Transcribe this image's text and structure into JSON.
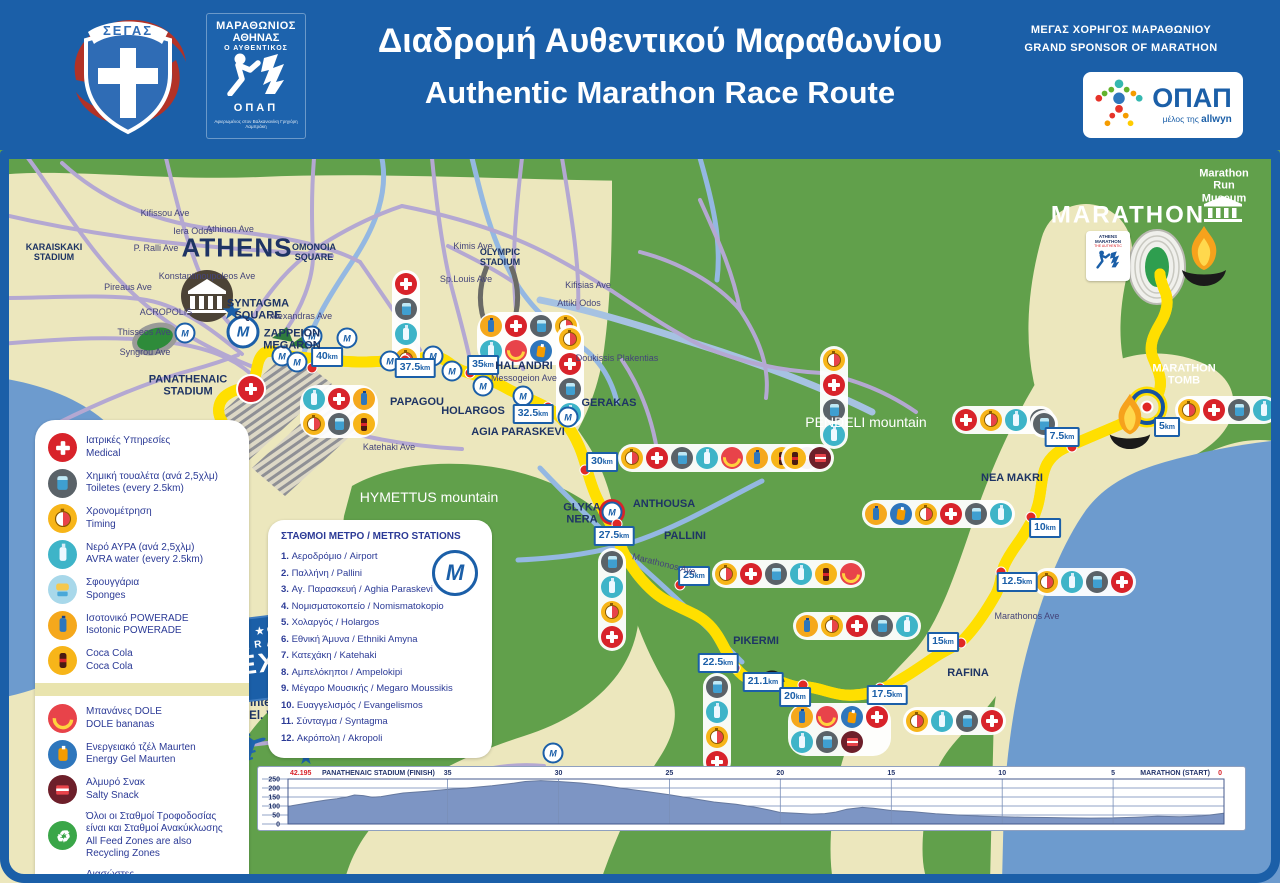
{
  "header": {
    "segas_label": "ΣΕΓΑΣ",
    "marathon_logo": {
      "line1": "ΜΑΡΑΘΩΝΙΟΣ",
      "line2": "ΑΘΗΝΑΣ",
      "line3": "Ο ΑΥΘΕΝΤΙΚΟΣ",
      "opap": "ΟΠΑΠ",
      "caption": "Αφιερωμένος στον Βαλκανιονίκη Γρηγόρη Λαμπράκη"
    },
    "title_el": "Διαδρομή Αυθεντικού Μαραθωνίου",
    "title_en": "Authentic Marathon Race Route",
    "sponsor_line_el": "ΜΕΓΑΣ ΧΟΡΗΓΟΣ ΜΑΡΑΘΩΝΙΟΥ",
    "sponsor_line_en": "GRAND SPONSOR OF MARATHON",
    "opap": {
      "name": "ΟΠΑΠ",
      "member": "μέλος της",
      "brand": "allwyn"
    }
  },
  "legend": {
    "items": [
      {
        "icon": "medical",
        "el": "Ιατρικές Υπηρεσίες",
        "en": "Medical"
      },
      {
        "icon": "toilet",
        "el": "Χημική τουαλέτα (ανά 2,5χλμ)",
        "en": "Toiletes (every 2.5km)"
      },
      {
        "icon": "timing",
        "el": "Χρονομέτρηση",
        "en": "Timing"
      },
      {
        "icon": "water",
        "el": "Νερό ΑΥΡΑ (ανά 2,5χλμ)",
        "en": "AVRA water (every 2.5km)"
      },
      {
        "icon": "sponge",
        "el": "Σφουγγάρια",
        "en": "Sponges"
      },
      {
        "icon": "powerade",
        "el": "Ισοτονικό POWERADE",
        "en": "Isotonic POWERADE"
      },
      {
        "icon": "coke",
        "el": "Coca Cola",
        "en": "Coca Cola"
      },
      {
        "icon": "banana",
        "el": "Μπανάνες DOLE",
        "en": "DOLE bananas",
        "group": 2
      },
      {
        "icon": "gel",
        "el": "Ενεργειακό τζέλ Maurten",
        "en": "Energy Gel Maurten",
        "group": 2
      },
      {
        "icon": "salty",
        "el": "Αλμυρό Σνακ",
        "en": "Salty Snack",
        "group": 2
      },
      {
        "icon": "recycle",
        "el": "Όλοι οι Σταθμοί Τροφοδοσίας είναι και Σταθμοί Ανακύκλωσης",
        "en": "All Feed Zones are also Recycling Zones",
        "group": 2
      },
      {
        "icon": "rescue",
        "el": "Διασώστες",
        "en": "Rescue Team",
        "group": 2
      }
    ]
  },
  "metro": {
    "title": "ΣΤΑΘΜΟΙ ΜΕΤΡΟ / METRO STATIONS",
    "stations": [
      {
        "n": "1.",
        "el": "Αεροδρόμιο",
        "en": "Airport"
      },
      {
        "n": "2.",
        "el": "Παλλήνη",
        "en": "Pallini"
      },
      {
        "n": "3.",
        "el": "Αγ. Παρασκευή",
        "en": "Aghia Paraskevi"
      },
      {
        "n": "4.",
        "el": "Νομισματοκοπείο",
        "en": "Nomismatokopio"
      },
      {
        "n": "5.",
        "el": "Χολαργός",
        "en": "Holargos"
      },
      {
        "n": "6.",
        "el": "Εθνική Άμυνα",
        "en": "Ethniki Amyna"
      },
      {
        "n": "7.",
        "el": "Κατεχάκη",
        "en": "Katehaki"
      },
      {
        "n": "8.",
        "el": "Αμπελόκηποι",
        "en": "Ampelokipi"
      },
      {
        "n": "9.",
        "el": "Μέγαρο Μουσικής",
        "en": "Megaro Moussikis"
      },
      {
        "n": "10.",
        "el": "Ευαγγελισμός",
        "en": "Evangelismos"
      },
      {
        "n": "11.",
        "el": "Σύνταγμα",
        "en": "Syntagma"
      },
      {
        "n": "12.",
        "el": "Ακρόπολη",
        "en": "Akropoli"
      }
    ]
  },
  "map": {
    "km_unit": "km",
    "metro_glyph": "M",
    "glyphs": {
      "plane": "✈",
      "star": "★",
      "recycle": "♻"
    },
    "expo": {
      "brand": "ΟΠΑΠ",
      "line1": "MARATHON",
      "line2": "EXPO"
    },
    "athens_logo": {
      "l1": "ATHENS",
      "l2": "MARATHON",
      "l3": "THE AUTHENTIC"
    },
    "labels": [
      {
        "t": "ATHENS",
        "x": 237,
        "y": 248,
        "c": "city"
      },
      {
        "t": "MARATHON",
        "x": 1128,
        "y": 216,
        "c": "bigwhite"
      },
      {
        "t": "KARAISKAKI\nSTADIUM",
        "x": 54,
        "y": 252,
        "c": "towns"
      },
      {
        "t": "OMONOIA\nSQUARE",
        "x": 314,
        "y": 252,
        "c": "towns"
      },
      {
        "t": "SYNTAGMA\nSQUARE",
        "x": 258,
        "y": 310,
        "c": "town"
      },
      {
        "t": "ZAPPEION\nMEGARON",
        "x": 292,
        "y": 340,
        "c": "town"
      },
      {
        "t": "PANATHENAIC\nSTADIUM",
        "x": 188,
        "y": 386,
        "c": "town"
      },
      {
        "t": "ACROPOLIS",
        "x": 166,
        "y": 312,
        "c": "street"
      },
      {
        "t": "Kifissou Ave",
        "x": 165,
        "y": 213,
        "c": "street"
      },
      {
        "t": "Iera Odos",
        "x": 193,
        "y": 231,
        "c": "street"
      },
      {
        "t": "Athinon Ave",
        "x": 230,
        "y": 229,
        "c": "street"
      },
      {
        "t": "P. Ralli Ave",
        "x": 156,
        "y": 248,
        "c": "street"
      },
      {
        "t": "Konstantinoupoleos Ave",
        "x": 207,
        "y": 276,
        "c": "street"
      },
      {
        "t": "Pireaus Ave",
        "x": 128,
        "y": 287,
        "c": "street"
      },
      {
        "t": "Thisseos Ave",
        "x": 144,
        "y": 332,
        "c": "street"
      },
      {
        "t": "Syngrou Ave",
        "x": 145,
        "y": 352,
        "c": "street"
      },
      {
        "t": "Alexandras Ave",
        "x": 301,
        "y": 316,
        "c": "street"
      },
      {
        "t": "Katehaki Ave",
        "x": 389,
        "y": 447,
        "c": "street"
      },
      {
        "t": "Kimis Ave",
        "x": 473,
        "y": 246,
        "c": "street"
      },
      {
        "t": "OLYMPIC\nSTADIUM",
        "x": 500,
        "y": 257,
        "c": "towns"
      },
      {
        "t": "Sp.Louis Ave",
        "x": 466,
        "y": 279,
        "c": "street"
      },
      {
        "t": "Kifisias Ave",
        "x": 588,
        "y": 285,
        "c": "street"
      },
      {
        "t": "Attiki Odos",
        "x": 579,
        "y": 303,
        "c": "street"
      },
      {
        "t": "Doukissis Plakentias",
        "x": 617,
        "y": 358,
        "c": "street"
      },
      {
        "t": "HALANDRI",
        "x": 524,
        "y": 366,
        "c": "town"
      },
      {
        "t": "Messogeion Ave",
        "x": 524,
        "y": 378,
        "c": "street"
      },
      {
        "t": "PAPAGOU",
        "x": 417,
        "y": 402,
        "c": "town"
      },
      {
        "t": "HOLARGOS",
        "x": 473,
        "y": 411,
        "c": "town"
      },
      {
        "t": "AGIA PARASKEVI",
        "x": 518,
        "y": 432,
        "c": "town"
      },
      {
        "t": "GERAKAS",
        "x": 609,
        "y": 403,
        "c": "town"
      },
      {
        "t": "HYMETTUS mountain",
        "x": 429,
        "y": 498,
        "c": "mtn"
      },
      {
        "t": "PENDELI mountain",
        "x": 866,
        "y": 423,
        "c": "mtn"
      },
      {
        "t": "GLYKA\nNERA",
        "x": 582,
        "y": 514,
        "c": "town"
      },
      {
        "t": "ANTHOUSA",
        "x": 664,
        "y": 504,
        "c": "town"
      },
      {
        "t": "PALLINI",
        "x": 685,
        "y": 536,
        "c": "town"
      },
      {
        "t": "PIKERMI",
        "x": 756,
        "y": 641,
        "c": "town"
      },
      {
        "t": "Marathonos Ave",
        "x": 664,
        "y": 564,
        "c": "street",
        "r": 14
      },
      {
        "t": "Marathonos Ave",
        "x": 1027,
        "y": 616,
        "c": "street"
      },
      {
        "t": "RAFINA",
        "x": 968,
        "y": 673,
        "c": "town"
      },
      {
        "t": "NEA MAKRI",
        "x": 1012,
        "y": 478,
        "c": "town"
      },
      {
        "t": "MARATHON TOMB",
        "x": 1184,
        "y": 375,
        "c": "wsmall"
      },
      {
        "t": "Marathon Run\nMuseum",
        "x": 1224,
        "y": 186,
        "c": "wsmall"
      },
      {
        "t": "Athens International Airport\n“El. Venizelos”",
        "x": 284,
        "y": 710,
        "c": "airport"
      }
    ],
    "km_markers": [
      {
        "t": "40",
        "x": 327,
        "y": 357
      },
      {
        "t": "37.5",
        "x": 415,
        "y": 368
      },
      {
        "t": "35",
        "x": 483,
        "y": 365
      },
      {
        "t": "32.5",
        "x": 533,
        "y": 414
      },
      {
        "t": "30",
        "x": 602,
        "y": 462
      },
      {
        "t": "27.5",
        "x": 614,
        "y": 536
      },
      {
        "t": "25",
        "x": 694,
        "y": 576
      },
      {
        "t": "22.5",
        "x": 718,
        "y": 663
      },
      {
        "t": "21.1",
        "x": 763,
        "y": 682
      },
      {
        "t": "20",
        "x": 795,
        "y": 697
      },
      {
        "t": "17.5",
        "x": 887,
        "y": 695
      },
      {
        "t": "15",
        "x": 943,
        "y": 642
      },
      {
        "t": "12.5",
        "x": 1017,
        "y": 582
      },
      {
        "t": "10",
        "x": 1045,
        "y": 528
      },
      {
        "t": "7.5",
        "x": 1062,
        "y": 437
      },
      {
        "t": "5",
        "x": 1167,
        "y": 427
      }
    ],
    "dots": [
      [
        312,
        368
      ],
      [
        405,
        360
      ],
      [
        470,
        373
      ],
      [
        548,
        407
      ],
      [
        585,
        470
      ],
      [
        617,
        524
      ],
      [
        680,
        585
      ],
      [
        735,
        668
      ],
      [
        803,
        685
      ],
      [
        880,
        688
      ],
      [
        961,
        643
      ],
      [
        1001,
        572
      ],
      [
        1031,
        517
      ],
      [
        1072,
        447
      ]
    ],
    "metro_icons": [
      {
        "x": 185,
        "y": 333
      },
      {
        "x": 243,
        "y": 332,
        "b": 1
      },
      {
        "x": 312,
        "y": 336
      },
      {
        "x": 282,
        "y": 356
      },
      {
        "x": 297,
        "y": 362
      },
      {
        "x": 347,
        "y": 338
      },
      {
        "x": 390,
        "y": 361
      },
      {
        "x": 433,
        "y": 356
      },
      {
        "x": 452,
        "y": 371
      },
      {
        "x": 483,
        "y": 386
      },
      {
        "x": 523,
        "y": 396
      },
      {
        "x": 568,
        "y": 417
      },
      {
        "x": 612,
        "y": 512,
        "r": 1
      },
      {
        "x": 553,
        "y": 753
      }
    ],
    "clusters": [
      {
        "x": 392,
        "y": 270,
        "dir": "v",
        "icons": [
          "medical",
          "toilet",
          "water",
          "timing"
        ]
      },
      {
        "x": 477,
        "y": 312,
        "dir": "g",
        "cols": 4,
        "icons": [
          "powerade",
          "medical",
          "toilet",
          "timing",
          "water",
          "banana",
          "gel"
        ]
      },
      {
        "x": 556,
        "y": 325,
        "dir": "v",
        "icons": [
          "timing",
          "medical",
          "toilet",
          "water"
        ]
      },
      {
        "x": 300,
        "y": 385,
        "dir": "g",
        "cols": 3,
        "icons": [
          "water",
          "medical",
          "powerade",
          "timing",
          "toilet",
          "coke"
        ]
      },
      {
        "x": 618,
        "y": 444,
        "dir": "h",
        "icons": [
          "timing",
          "medical",
          "toilet",
          "water",
          "banana",
          "powerade",
          "coke",
          "salty"
        ]
      },
      {
        "x": 712,
        "y": 560,
        "dir": "h",
        "icons": [
          "timing",
          "medical",
          "toilet",
          "water",
          "coke",
          "banana"
        ]
      },
      {
        "x": 793,
        "y": 612,
        "dir": "h",
        "icons": [
          "powerade",
          "timing",
          "medical",
          "toilet",
          "water"
        ]
      },
      {
        "x": 788,
        "y": 703,
        "dir": "g",
        "cols": 4,
        "icons": [
          "powerade",
          "banana",
          "gel",
          "medical",
          "water",
          "toilet",
          "salty"
        ]
      },
      {
        "x": 903,
        "y": 707,
        "dir": "h",
        "icons": [
          "timing",
          "water",
          "toilet",
          "medical"
        ]
      },
      {
        "x": 703,
        "y": 673,
        "dir": "v",
        "icons": [
          "toilet",
          "water",
          "timing",
          "medical"
        ]
      },
      {
        "x": 598,
        "y": 548,
        "dir": "v",
        "icons": [
          "toilet",
          "water",
          "timing",
          "medical"
        ]
      },
      {
        "x": 1033,
        "y": 568,
        "dir": "h",
        "icons": [
          "timing",
          "water",
          "toilet",
          "medical"
        ]
      },
      {
        "x": 862,
        "y": 500,
        "dir": "h",
        "icons": [
          "powerade",
          "gel",
          "timing",
          "medical",
          "toilet",
          "water"
        ]
      },
      {
        "x": 952,
        "y": 406,
        "dir": "h",
        "icons": [
          "medical",
          "timing",
          "water",
          "toilet"
        ]
      },
      {
        "x": 781,
        "y": 444,
        "dir": "h",
        "icons": [
          "coke",
          "salty"
        ]
      },
      {
        "x": 1175,
        "y": 396,
        "dir": "h",
        "icons": [
          "timing",
          "medical",
          "toilet",
          "water"
        ]
      },
      {
        "x": 1030,
        "y": 410,
        "dir": "h",
        "icons": [
          "toilet"
        ]
      },
      {
        "x": 820,
        "y": 346,
        "dir": "v",
        "icons": [
          "timing",
          "medical",
          "toilet",
          "water"
        ]
      },
      {
        "x": 236,
        "y": 374,
        "dir": "h",
        "plain": 1,
        "icons": [
          "medical"
        ]
      }
    ]
  },
  "elevation": {
    "finish_value": "42.195",
    "finish_label": "PANATHENAIC STADIUM (FINISH)",
    "start_label": "MARATHON (START)",
    "start_value": "0",
    "ticks": [
      35,
      30,
      25,
      20,
      15,
      10,
      5
    ],
    "ylabels": [
      250,
      200,
      150,
      100,
      50,
      0
    ],
    "points": [
      [
        0,
        60
      ],
      [
        0.5,
        52
      ],
      [
        1,
        45
      ],
      [
        1.5,
        42
      ],
      [
        2,
        40
      ],
      [
        3,
        43
      ],
      [
        4,
        38
      ],
      [
        5,
        34
      ],
      [
        6,
        33
      ],
      [
        7,
        34
      ],
      [
        8,
        36
      ],
      [
        9,
        38
      ],
      [
        10,
        40
      ],
      [
        11,
        44
      ],
      [
        12,
        50
      ],
      [
        13,
        57
      ],
      [
        14,
        68
      ],
      [
        15,
        75
      ],
      [
        15.8,
        88
      ],
      [
        16.3,
        92
      ],
      [
        17,
        82
      ],
      [
        17.5,
        66
      ],
      [
        18,
        58
      ],
      [
        18.6,
        55
      ],
      [
        19.3,
        60
      ],
      [
        20,
        64
      ],
      [
        20.5,
        78
      ],
      [
        21,
        90
      ],
      [
        21.6,
        102
      ],
      [
        22,
        110
      ],
      [
        23,
        122
      ],
      [
        24,
        142
      ],
      [
        25,
        163
      ],
      [
        26,
        180
      ],
      [
        27,
        196
      ],
      [
        28,
        214
      ],
      [
        29,
        228
      ],
      [
        30,
        236
      ],
      [
        30.8,
        241
      ],
      [
        31.5,
        236
      ],
      [
        32,
        227
      ],
      [
        33,
        212
      ],
      [
        34,
        201
      ],
      [
        35,
        192
      ],
      [
        36,
        181
      ],
      [
        37,
        172
      ],
      [
        37.5,
        163
      ],
      [
        38,
        152
      ],
      [
        38.4,
        149
      ],
      [
        38.8,
        158
      ],
      [
        39.2,
        161
      ],
      [
        39.6,
        148
      ],
      [
        40,
        140
      ],
      [
        40.5,
        133
      ],
      [
        41,
        123
      ],
      [
        41.5,
        113
      ],
      [
        42,
        102
      ],
      [
        42.195,
        97
      ]
    ]
  },
  "colors": {
    "header_blue": "#1b5fa8",
    "route_blue": "#15529e",
    "route_yellow": "#ffdf00",
    "land": "#ece7bd",
    "green": "#61a04b",
    "sea": "#6d9bce",
    "street": "#b4a8d2",
    "river": "#94b8e2",
    "navy": "#1e3464",
    "legend_text": "#2b3a96",
    "red": "#d8232a"
  }
}
